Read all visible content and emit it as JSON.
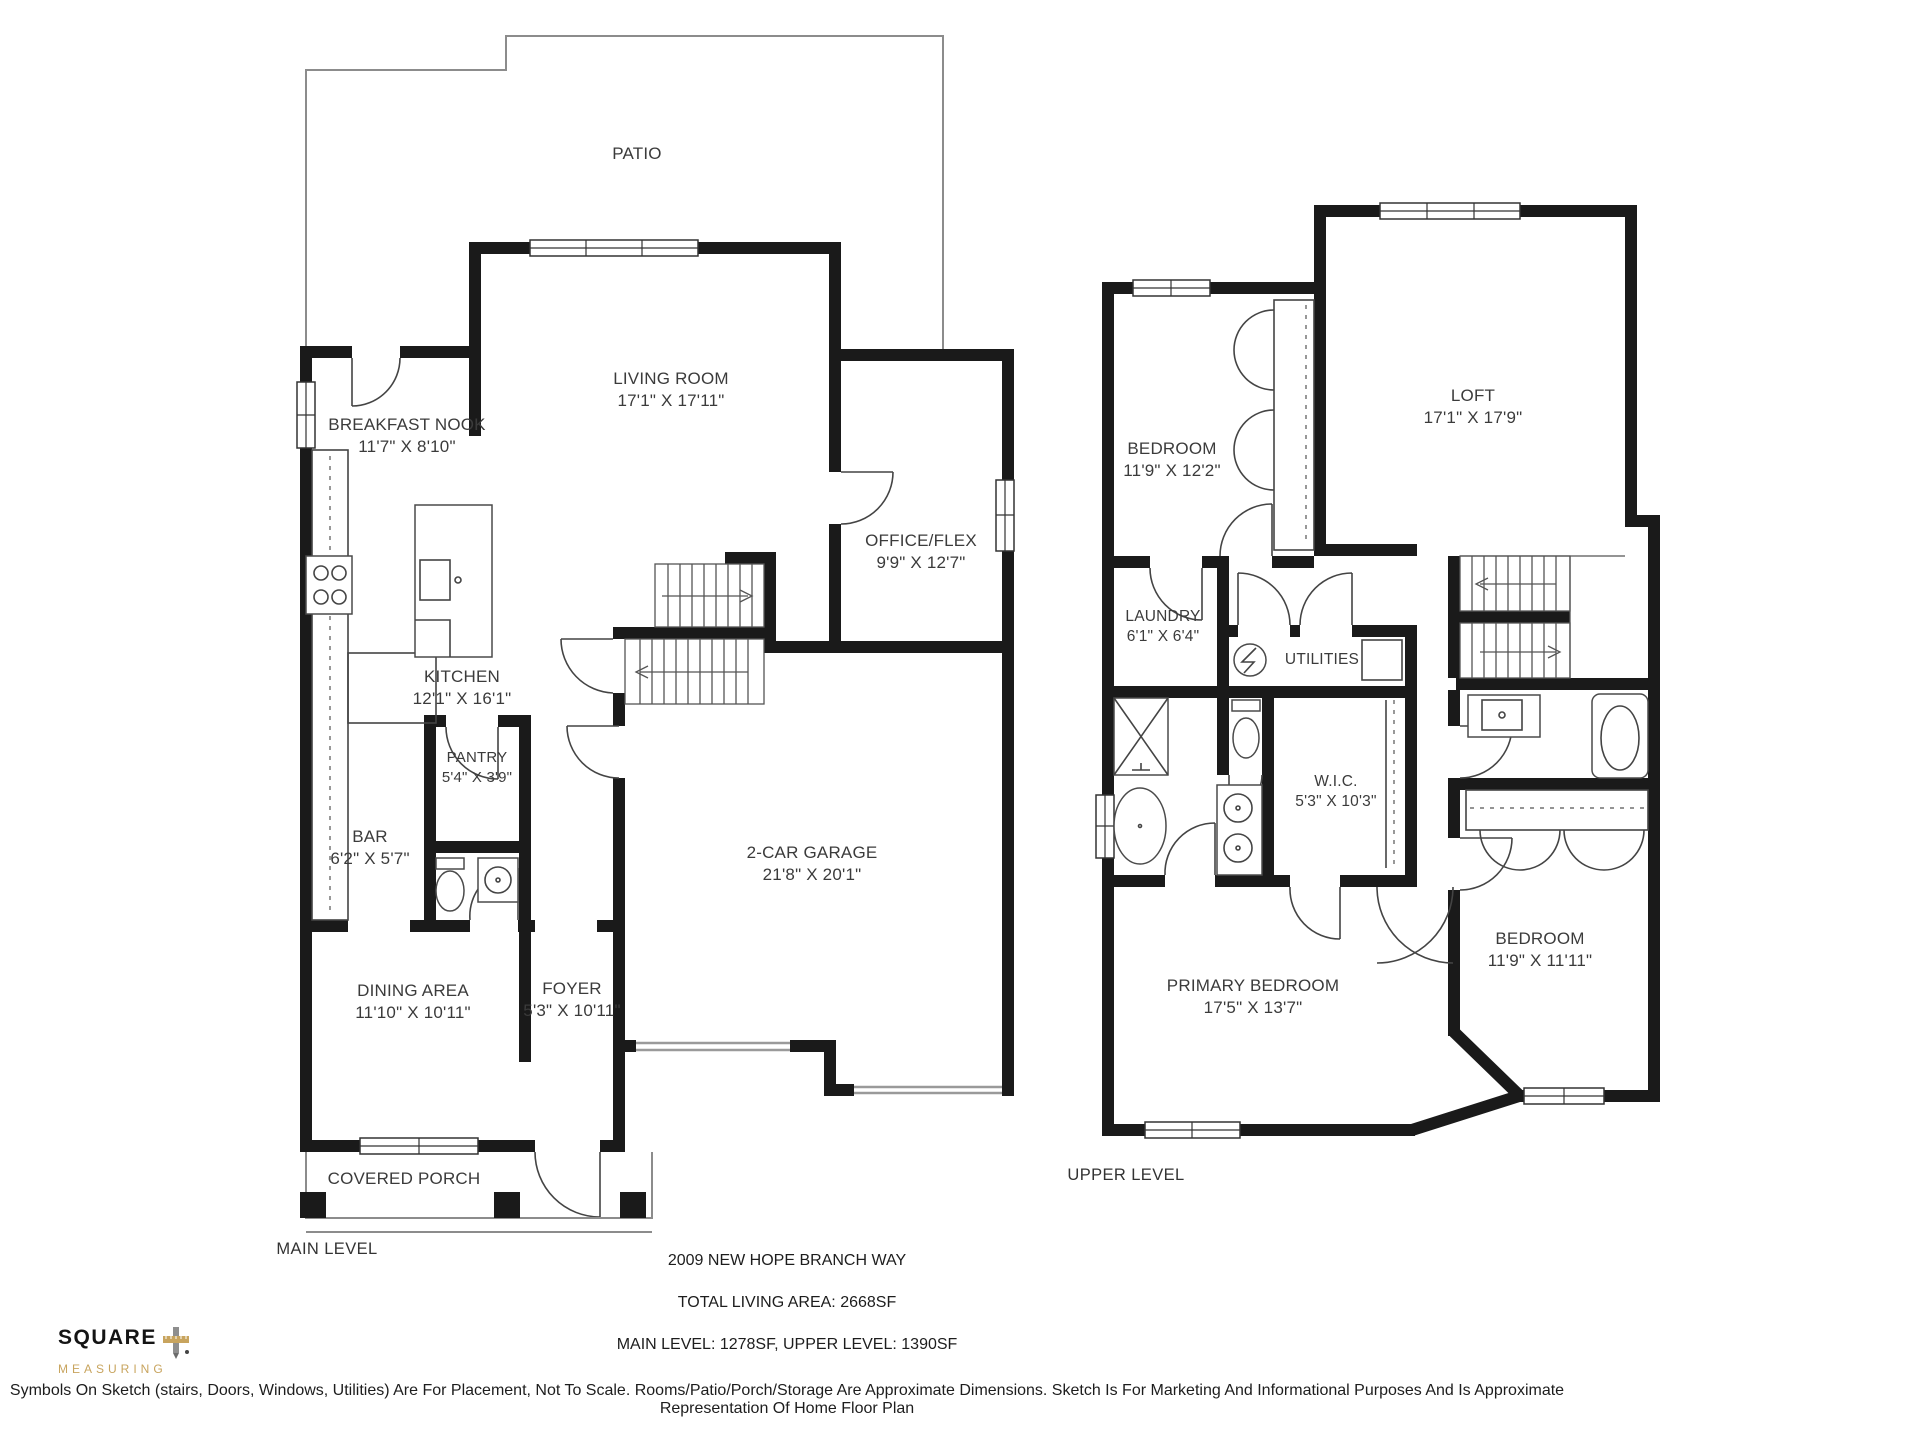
{
  "title_block": {
    "address": "2009 NEW HOPE BRANCH WAY",
    "total_area": "TOTAL LIVING AREA: 2668SF",
    "level_areas": "MAIN LEVEL: 1278SF, UPPER LEVEL: 1390SF",
    "disclaimer": "Symbols On Sketch (stairs, Doors, Windows, Utilities) Are For Placement, Not To Scale. Rooms/Patio/Porch/Storage Are Approximate Dimensions. Sketch Is For Marketing And Informational Purposes And Is Approximate Representation Of Home Floor Plan"
  },
  "logo": {
    "name": "SQUARE",
    "tagline": "MEASURING"
  },
  "main_level": {
    "label": "MAIN LEVEL",
    "rooms": {
      "patio": {
        "name": "PATIO",
        "dims": ""
      },
      "living_room": {
        "name": "LIVING ROOM",
        "dims": "17'1\" X 17'11\""
      },
      "breakfast_nook": {
        "name": "BREAKFAST NOOK",
        "dims": "11'7\" X 8'10\""
      },
      "office_flex": {
        "name": "OFFICE/FLEX",
        "dims": "9'9\" X 12'7\""
      },
      "kitchen": {
        "name": "KITCHEN",
        "dims": "12'1\" X 16'1\""
      },
      "pantry": {
        "name": "PANTRY",
        "dims": "5'4\" X 3'9\""
      },
      "bar": {
        "name": "BAR",
        "dims": "6'2\" X 5'7\""
      },
      "garage": {
        "name": "2-CAR GARAGE",
        "dims": "21'8\" X 20'1\""
      },
      "dining_area": {
        "name": "DINING AREA",
        "dims": "11'10\" X 10'11\""
      },
      "foyer": {
        "name": "FOYER",
        "dims": "5'3\" X 10'11\""
      },
      "covered_porch": {
        "name": "COVERED PORCH",
        "dims": ""
      }
    }
  },
  "upper_level": {
    "label": "UPPER LEVEL",
    "rooms": {
      "bedroom": {
        "name": "BEDROOM",
        "dims": "11'9\" X 12'2\""
      },
      "loft": {
        "name": "LOFT",
        "dims": "17'1\" X 17'9\""
      },
      "laundry": {
        "name": "LAUNDRY",
        "dims": "6'1\" X 6'4\""
      },
      "utilities": {
        "name": "UTILITIES",
        "dims": ""
      },
      "wic": {
        "name": "W.I.C.",
        "dims": "5'3\" X 10'3\""
      },
      "primary_bedroom": {
        "name": "PRIMARY BEDROOM",
        "dims": "17'5\" X 13'7\""
      },
      "bedroom_2": {
        "name": "BEDROOM",
        "dims": "11'9\" X 11'11\""
      }
    }
  }
}
